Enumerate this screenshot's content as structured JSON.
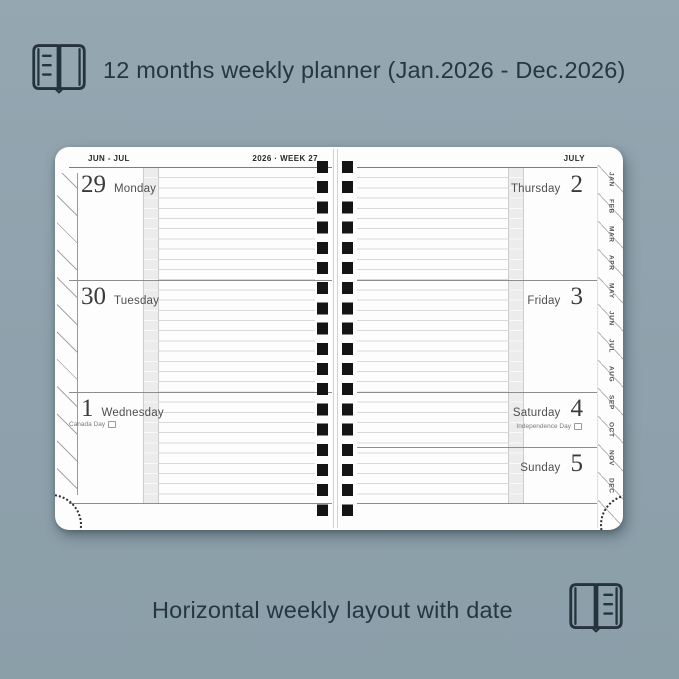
{
  "colors": {
    "background": "#90A3AE",
    "caption_text": "#273640",
    "page": "#FDFDFD",
    "rule_line": "#D9D9D9",
    "section_divider": "#8D8D8D",
    "shaded_column": "#ECECEC",
    "spiral_binding": "#141414"
  },
  "top_banner": {
    "icon": "open-book-icon",
    "title": "12 months weekly planner (Jan.2026 - Dec.2026)"
  },
  "bottom_banner": {
    "icon": "open-book-icon",
    "title": "Horizontal weekly layout with date"
  },
  "planner": {
    "left_page": {
      "header_month": "JUN - JUL",
      "header_week": "2026 · WEEK 27",
      "days": [
        {
          "date": "29",
          "name": "Monday",
          "holiday": ""
        },
        {
          "date": "30",
          "name": "Tuesday",
          "holiday": ""
        },
        {
          "date": "1",
          "name": "Wednesday",
          "holiday": "Canada Day"
        }
      ]
    },
    "right_page": {
      "header_month": "JULY",
      "days": [
        {
          "date": "2",
          "name": "Thursday",
          "holiday": ""
        },
        {
          "date": "3",
          "name": "Friday",
          "holiday": ""
        },
        {
          "date": "4",
          "name": "Saturday",
          "holiday": "Independence Day"
        },
        {
          "date": "5",
          "name": "Sunday",
          "holiday": ""
        }
      ]
    },
    "month_tabs": [
      "JAN",
      "FEB",
      "MAR",
      "APR",
      "MAY",
      "JUN",
      "JUL",
      "AUG",
      "SEP",
      "OCT",
      "NOV",
      "DEC"
    ]
  }
}
